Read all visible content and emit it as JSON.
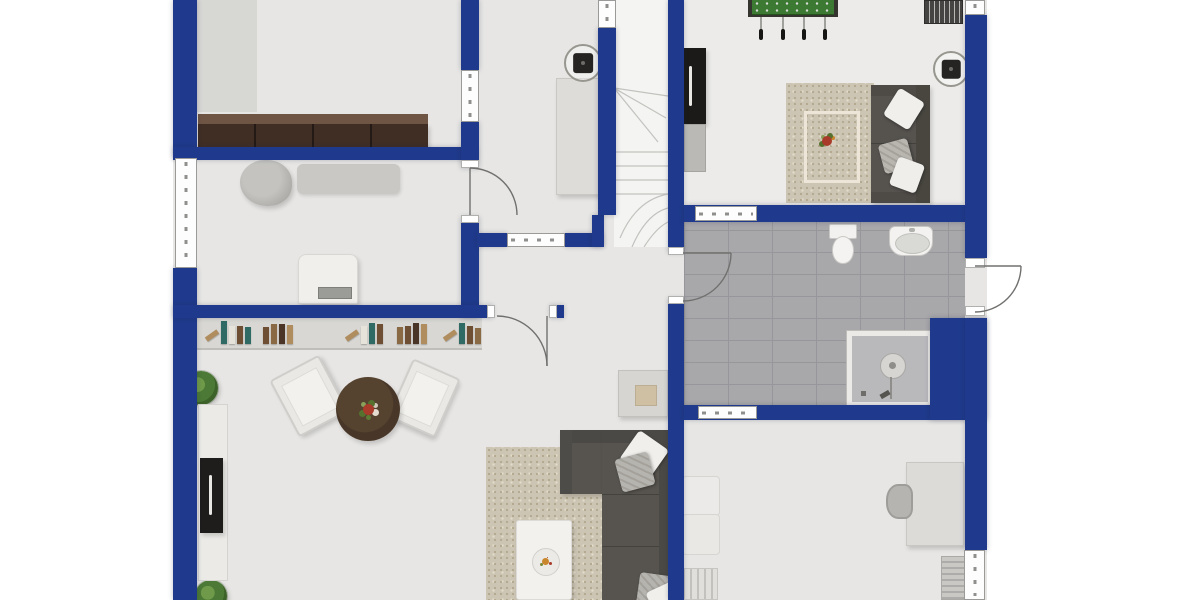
{
  "meta": {
    "kind": "floor-plan",
    "view": "top-down 2D render",
    "visible_text": "none"
  },
  "palette": {
    "wall": "#1f3a8c",
    "floor": "#e7e6e4",
    "gameroom_floor": "#ecebe9",
    "bath_tile": "#a8a8ab",
    "stairs": "#f4f4f2",
    "rug": "#cdc5b4",
    "sofa_dark": "#56534f",
    "sofa_brown": "#402e25",
    "table_brown": "#483728",
    "foosball_green": "#3c7a33",
    "cabinet_black": "#1b1a19",
    "background": "#ffffff"
  },
  "rooms": [
    {
      "name": "top-left-room",
      "furniture": [
        "floor-mat",
        "four-seat-brown-sofa-row"
      ]
    },
    {
      "name": "middle-left-room",
      "furniture": [
        "bean-bag",
        "gray-daybed",
        "desk-with-keyboard"
      ],
      "openings": [
        "left-exterior-window",
        "door-to-kitchen"
      ]
    },
    {
      "name": "kitchen",
      "furniture": [
        "counter",
        "round-ceiling-item"
      ],
      "openings": [
        "interior-window-west",
        "interior-window-south"
      ]
    },
    {
      "name": "staircase",
      "furniture": [
        "winder-stairs"
      ],
      "openings": [
        "interior-window-top"
      ]
    },
    {
      "name": "game-room",
      "furniture": [
        "foosball-table",
        "slatted-bench",
        "black-cabinet",
        "gray-cabinet",
        "bordered-rug-with-flowers",
        "gray-sofa-three-pillows",
        "round-ceiling-item"
      ]
    },
    {
      "name": "bathroom",
      "furniture": [
        "toilet",
        "washbasin",
        "shower"
      ],
      "openings": [
        "door-from-hall",
        "exterior-door-right",
        "interior-window-north",
        "interior-window-south"
      ]
    },
    {
      "name": "hallway",
      "furniture": [
        "side-table"
      ],
      "openings": [
        "door-to-living-room"
      ]
    },
    {
      "name": "living-room",
      "furniture": [
        "bookshelf",
        "plant-north",
        "plant-south",
        "sideboard-with-tv-panel",
        "armchair-left",
        "armchair-right",
        "round-coffee-table-with-flowers",
        "area-rug",
        "white-coffee-table-with-fruit-bowl",
        "corner-sofa-with-pillows"
      ]
    },
    {
      "name": "bedroom",
      "furniture": [
        "bed",
        "striped-unit",
        "desk",
        "desk-chair",
        "radiator"
      ],
      "openings": [
        "right-exterior-window"
      ]
    }
  ],
  "bookshelf": {
    "clusters": [
      {
        "x": 8,
        "books": [
          {
            "c": "#b08d5e",
            "lean": true
          },
          {
            "c": "#2f6b64"
          },
          {
            "c": "#e6e3da"
          },
          {
            "c": "#6e4f33"
          },
          {
            "c": "#2f6b64"
          }
        ]
      },
      {
        "x": 66,
        "books": [
          {
            "c": "#6e4f33"
          },
          {
            "c": "#8a6a45"
          },
          {
            "c": "#4a3526"
          },
          {
            "c": "#b08d5e"
          }
        ]
      },
      {
        "x": 148,
        "books": [
          {
            "c": "#b08d5e",
            "lean": true
          },
          {
            "c": "#e6e3da"
          },
          {
            "c": "#2f6b64"
          },
          {
            "c": "#6e4f33"
          }
        ]
      },
      {
        "x": 200,
        "books": [
          {
            "c": "#8a6a45"
          },
          {
            "c": "#6e4f33"
          },
          {
            "c": "#4a3526"
          },
          {
            "c": "#b08d5e"
          }
        ]
      },
      {
        "x": 246,
        "books": [
          {
            "c": "#b08d5e",
            "lean": true
          },
          {
            "c": "#2f6b64"
          },
          {
            "c": "#6e4f33"
          },
          {
            "c": "#8a6a45"
          }
        ]
      }
    ]
  },
  "doors": [
    {
      "name": "door-middle-left-to-kitchen",
      "swing": "into-kitchen"
    },
    {
      "name": "door-hall-to-living-room",
      "swing": "into-living-room"
    },
    {
      "name": "door-hall-to-bathroom",
      "swing": "into-bathroom"
    },
    {
      "name": "door-bathroom-exterior",
      "swing": "outward-right"
    }
  ]
}
